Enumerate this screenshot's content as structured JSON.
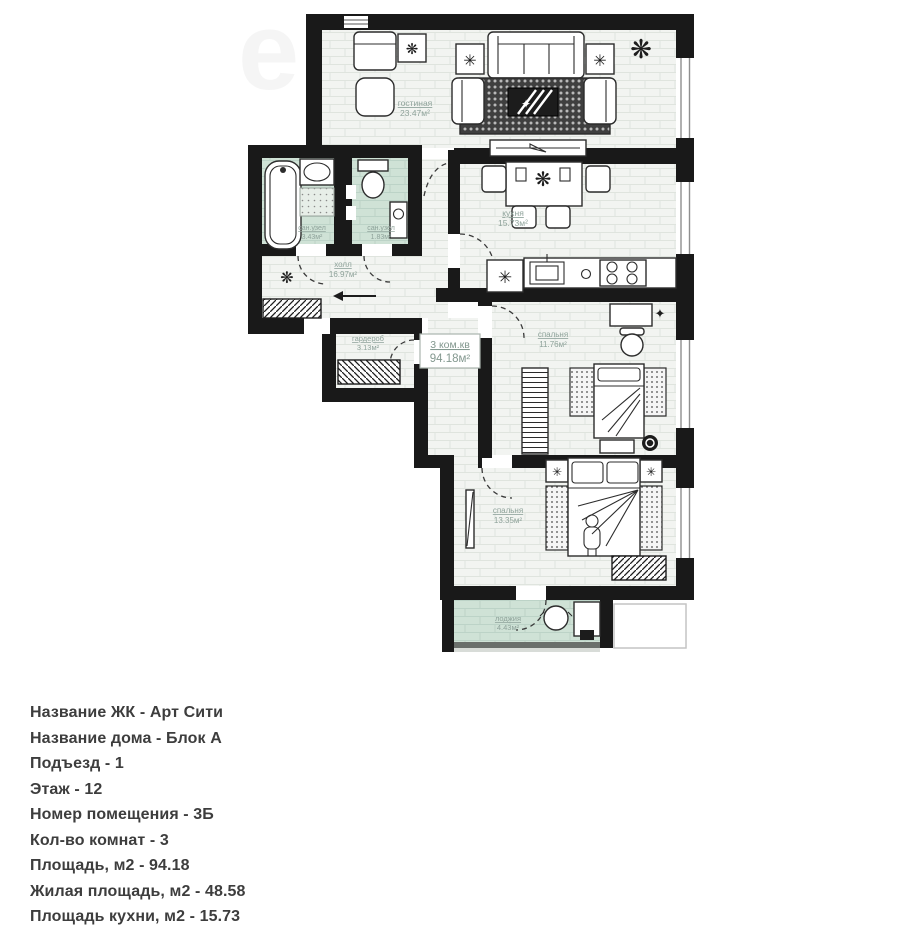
{
  "watermark": "е",
  "plan": {
    "unit": {
      "type_label": "3 ком.кв",
      "area_label": "94.18м²"
    },
    "rooms": {
      "living": {
        "name": "гостиная",
        "area": "23.47м²"
      },
      "kitchen": {
        "name": "кухня",
        "area": "15.73м²"
      },
      "bath1": {
        "name": "сан.узел",
        "area": "3.43м²"
      },
      "bath2": {
        "name": "сан.узел",
        "area": "1.83м²"
      },
      "hall": {
        "name": "холл",
        "area": "16.97м²"
      },
      "wardrobe": {
        "name": "гардероб",
        "area": "3.13м²"
      },
      "bedroom1": {
        "name": "спальня",
        "area": "11.76м²"
      },
      "bedroom2": {
        "name": "спальня",
        "area": "13.35м²"
      },
      "loggia": {
        "name": "лоджия",
        "area": "4.43м²"
      }
    },
    "colors": {
      "wall": "#191919",
      "floor": "#f2f4f1",
      "wet_floor": "#cfe2d6",
      "label": "#8ea29a",
      "text": "#3d3d3d"
    }
  },
  "details": {
    "lines": [
      "Название ЖК - Арт Сити",
      "Название дома - Блок А",
      "Подъезд - 1",
      "Этаж - 12",
      "Номер помещения - 3Б",
      "Кол-во комнат - 3",
      "Площадь, м2 - 94.18",
      "Жилая площадь, м2 - 48.58",
      "Площадь кухни, м2 - 15.73"
    ]
  }
}
